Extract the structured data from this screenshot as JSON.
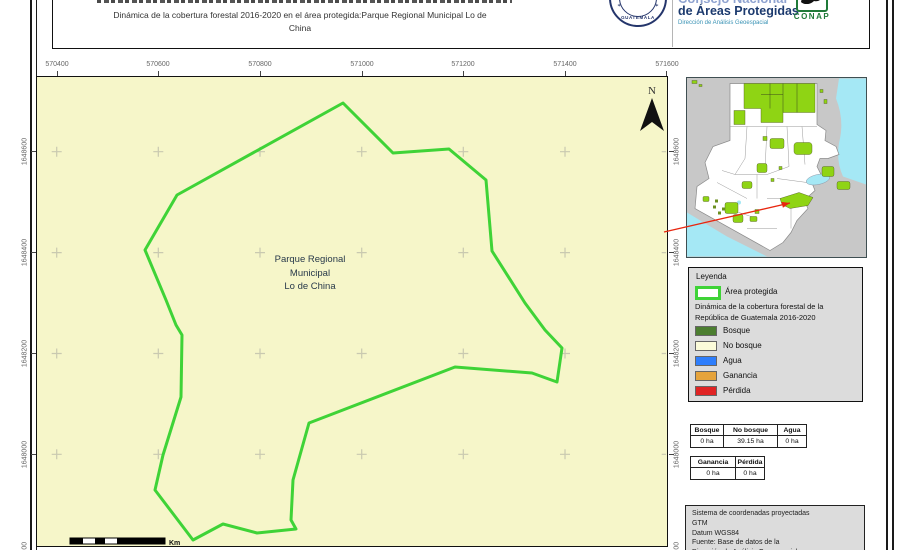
{
  "header": {
    "clipped_org_line": "Consejo Nacional",
    "org_line2": "de Áreas Protegidas",
    "org_subtitle": "Dirección de Análisis Geoespacial",
    "seal_text": "GUATEMALA",
    "conap_label": "CONAP",
    "title_line1": "Dinámica de la cobertura forestal 2016-2020 en el área protegida:Parque Regional Municipal Lo de",
    "title_line2": "China"
  },
  "map": {
    "background_color": "#f6f6c9",
    "outline_color": "#3fd337",
    "x_ticks": [
      "570400",
      "570600",
      "570800",
      "571000",
      "571200",
      "571400",
      "571600"
    ],
    "y_ticks": [
      "1648600",
      "1648400",
      "1648200",
      "1648000"
    ],
    "y_tick_partial": "1647800",
    "place_label": {
      "line1": "Parque Regional",
      "line2": "Municipal",
      "line3": "Lo de China"
    },
    "north_label": "N",
    "scale_unit": "Km"
  },
  "inset": {
    "land_color": "#c8c8c8",
    "country_color": "#ffffff",
    "water_color": "#a5e8f5",
    "protected_color": "#8fd414",
    "arrow_color": "#e8260f"
  },
  "legend": {
    "title": "Leyenda",
    "area_item_label": "Área protegida",
    "area_outline_color": "#3fd337",
    "subtitle_line1": "Dinámica de la cobertura forestal de la",
    "subtitle_line2": "República de Guatemala 2016-2020",
    "items": [
      {
        "label": "Bosque",
        "color": "#4c7e30"
      },
      {
        "label": "No bosque",
        "color": "#fbfbd9"
      },
      {
        "label": "Agua",
        "color": "#2e7efc"
      },
      {
        "label": "Ganancia",
        "color": "#e5a33b"
      },
      {
        "label": "Pérdida",
        "color": "#e02424"
      }
    ]
  },
  "stats": {
    "table1": {
      "headers": [
        "Bosque",
        "No bosque",
        "Agua"
      ],
      "values": [
        "0 ha",
        "39.15 ha",
        "0 ha"
      ]
    },
    "table2": {
      "headers": [
        "Ganancia",
        "Pérdida"
      ],
      "values": [
        "0 ha",
        "0 ha"
      ]
    }
  },
  "crs_box": {
    "lines": [
      "Sistema de coordenadas proyectadas",
      "GTM",
      "Datum WGS84",
      "Fuente: Base de datos de la",
      "Dirección de Análisis Geoespacial"
    ]
  }
}
